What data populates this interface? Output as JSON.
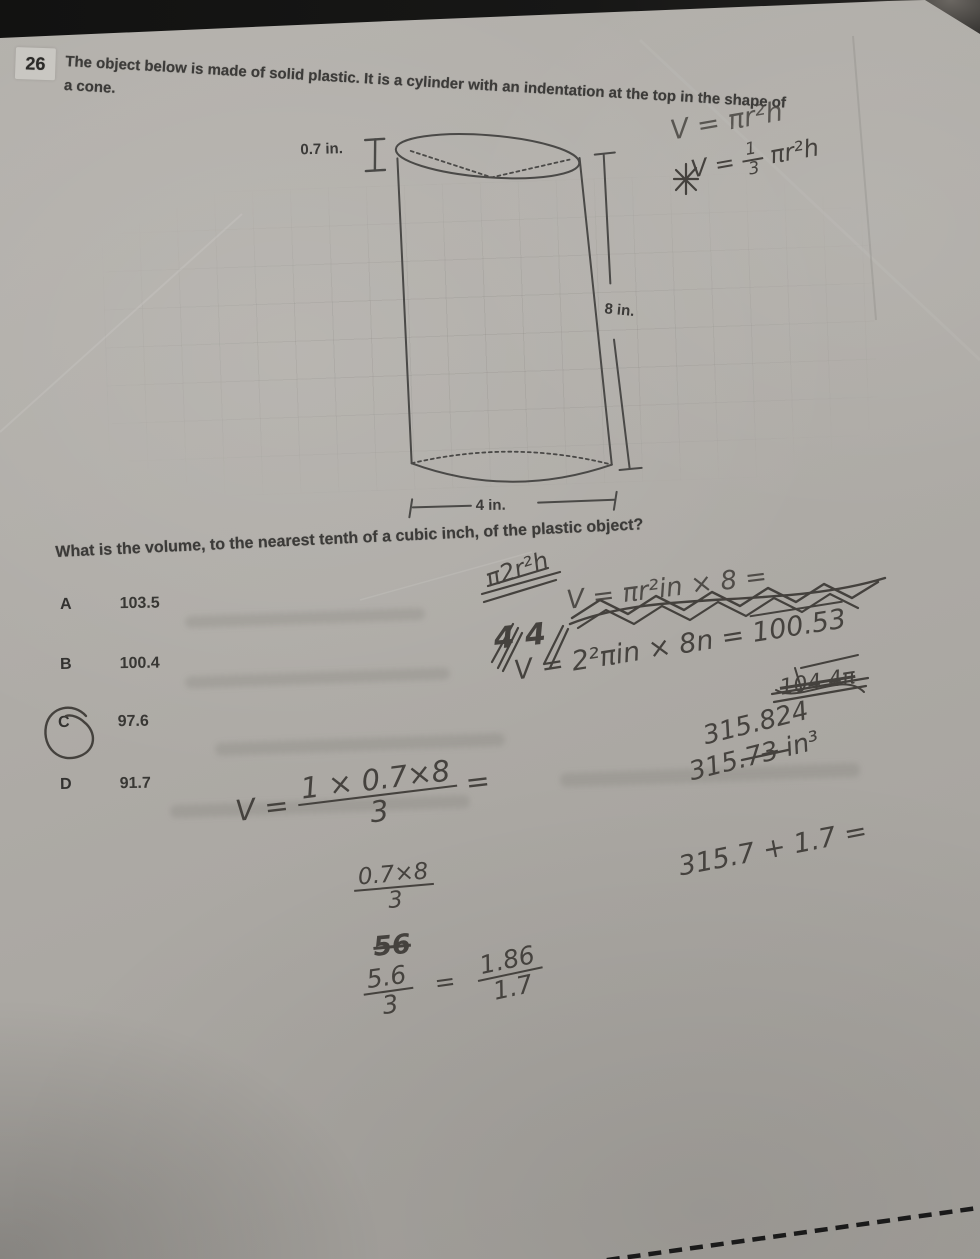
{
  "question": {
    "number": "26",
    "text": "The object below is made of solid plastic. It is a cylinder with an indentation at the top in the shape of a cone.",
    "prompt": "What is the volume, to the nearest tenth of a cubic inch, of the plastic object?"
  },
  "diagram": {
    "labels": {
      "indent_depth": "0.7 in.",
      "height": "8 in.",
      "diameter": "4 in."
    }
  },
  "choices": [
    {
      "letter": "A",
      "value": "103.5",
      "selected": false
    },
    {
      "letter": "B",
      "value": "100.4",
      "selected": false
    },
    {
      "letter": "C",
      "value": "97.6",
      "selected": true
    },
    {
      "letter": "D",
      "value": "91.7",
      "selected": false
    }
  ],
  "handwriting": {
    "formulas": {
      "cylinder": "V = πr²h",
      "cone_pre": "V =",
      "cone_num": "1",
      "cone_den": "3",
      "cone_post": "πr²h"
    },
    "scribbles": {
      "a": "π2r²h",
      "b": "4  4",
      "c": "V = πr²in × 8 ="
    },
    "calc": {
      "line": "V = 2²πin × 8n = ",
      "line_result": "100.53",
      "crossed": "104.4π",
      "result_raw": "315.824",
      "result_pre": "315.7",
      "result_struck": "3",
      "result_unit": " in³",
      "sum": "315.7 + 1.7 ="
    },
    "work": {
      "v": "V =",
      "f1_num": "1 × 0.7×8",
      "f1_den": "3",
      "f1_eq": "=",
      "f2_num": "0.7×8",
      "f2_den": "3",
      "crossed": "56",
      "f3_num": "5.6",
      "f3_den": "3",
      "eq": "=",
      "f4_num": "1.86",
      "f4_den": "1.7"
    }
  }
}
